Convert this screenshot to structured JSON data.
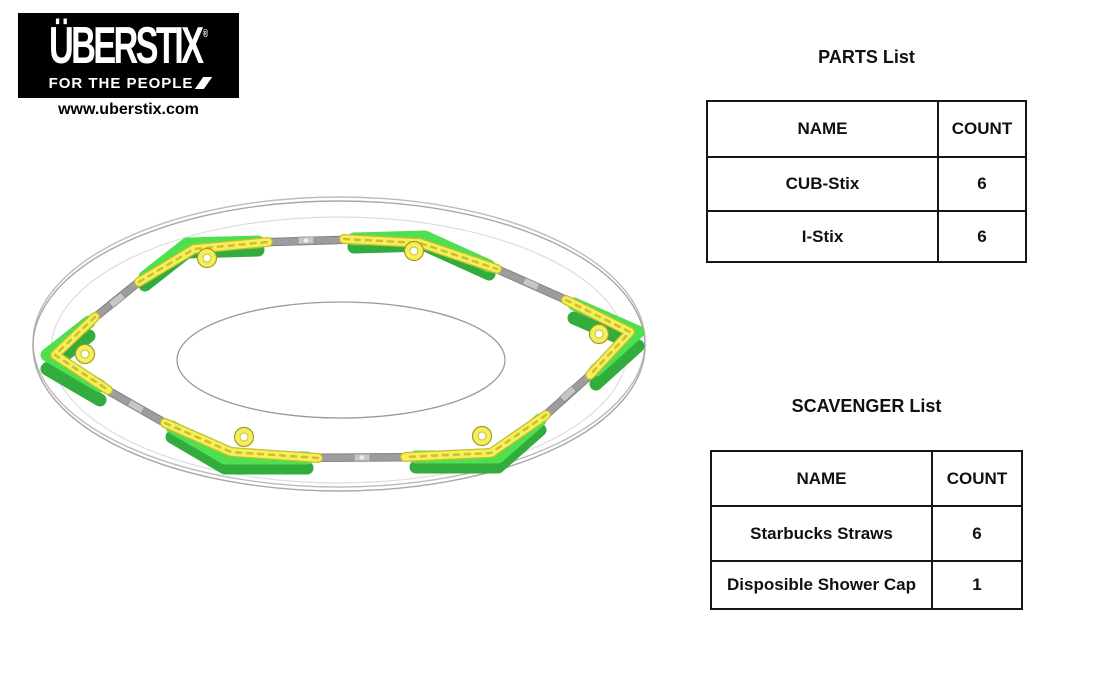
{
  "logo": {
    "brand": "ÜBERSTIX",
    "registered_mark": "®",
    "tagline": "FOR THE PEOPLE",
    "website": "www.uberstix.com"
  },
  "parts_list": {
    "title": "PARTS List",
    "headers": {
      "name": "NAME",
      "count": "COUNT"
    },
    "rows": [
      {
        "name": "CUB-Stix",
        "count": "6"
      },
      {
        "name": "I-Stix",
        "count": "6"
      }
    ]
  },
  "scavenger_list": {
    "title": "SCAVENGER List",
    "headers": {
      "name": "NAME",
      "count": "COUNT"
    },
    "rows": [
      {
        "name": "Starbucks Straws",
        "count": "6"
      },
      {
        "name": "Disposible Shower Cap",
        "count": "1"
      }
    ]
  },
  "illustration": {
    "description": "Hexagonal ring assembly: six green CUB-Stix corner pieces and six yellow I-Stix hub connectors joined by six gray Starbucks straws, laid on a clear disposable shower cap shown as concentric ellipses",
    "colors": {
      "cub_stix_green": "#4FE050",
      "cub_stix_green_dark": "#32AC3C",
      "i_stix_yellow": "#F4EF5C",
      "i_stix_yellow_dark": "#C9BC2E",
      "straw_gray": "#9D9D9D",
      "cap_outline_gray": "#ACACAC"
    }
  }
}
